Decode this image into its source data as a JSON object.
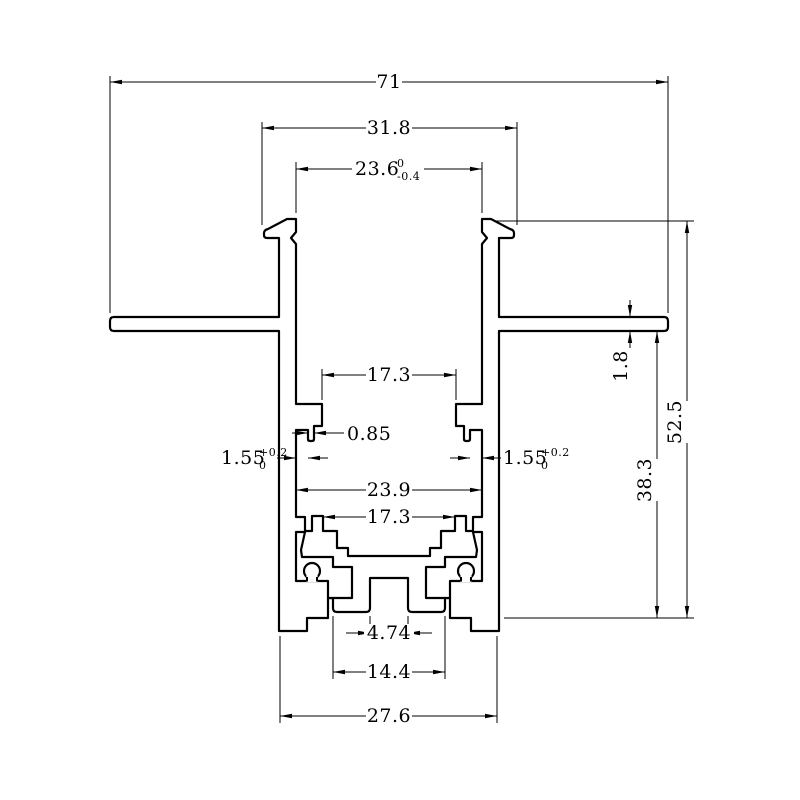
{
  "drawing": {
    "type": "technical-cross-section",
    "colors": {
      "line": "#000000",
      "background": "#ffffff"
    },
    "dimensions": {
      "overall_width": {
        "label": "71"
      },
      "upper_outer_width": {
        "label": "31.8"
      },
      "top_opening": {
        "label": "23.6",
        "tol_top": "0",
        "tol_bottom": "-0.4"
      },
      "upper_channel_width": {
        "label": "17.3"
      },
      "lip_thickness": {
        "label": "0.85"
      },
      "slot_width_left": {
        "label": "1.55",
        "tol_top": "+0.2",
        "tol_bottom": "0"
      },
      "slot_width_right": {
        "label": "1.55",
        "tol_top": "+0.2",
        "tol_bottom": "0"
      },
      "cavity_width": {
        "label": "23.9"
      },
      "lower_channel_width": {
        "label": "17.3"
      },
      "center_slot_width": {
        "label": "4.74"
      },
      "feet_span": {
        "label": "14.4"
      },
      "bottom_width": {
        "label": "27.6"
      },
      "flange_thickness": {
        "label": "1.8"
      },
      "body_height": {
        "label": "38.3"
      },
      "overall_height": {
        "label": "52.5"
      }
    }
  }
}
